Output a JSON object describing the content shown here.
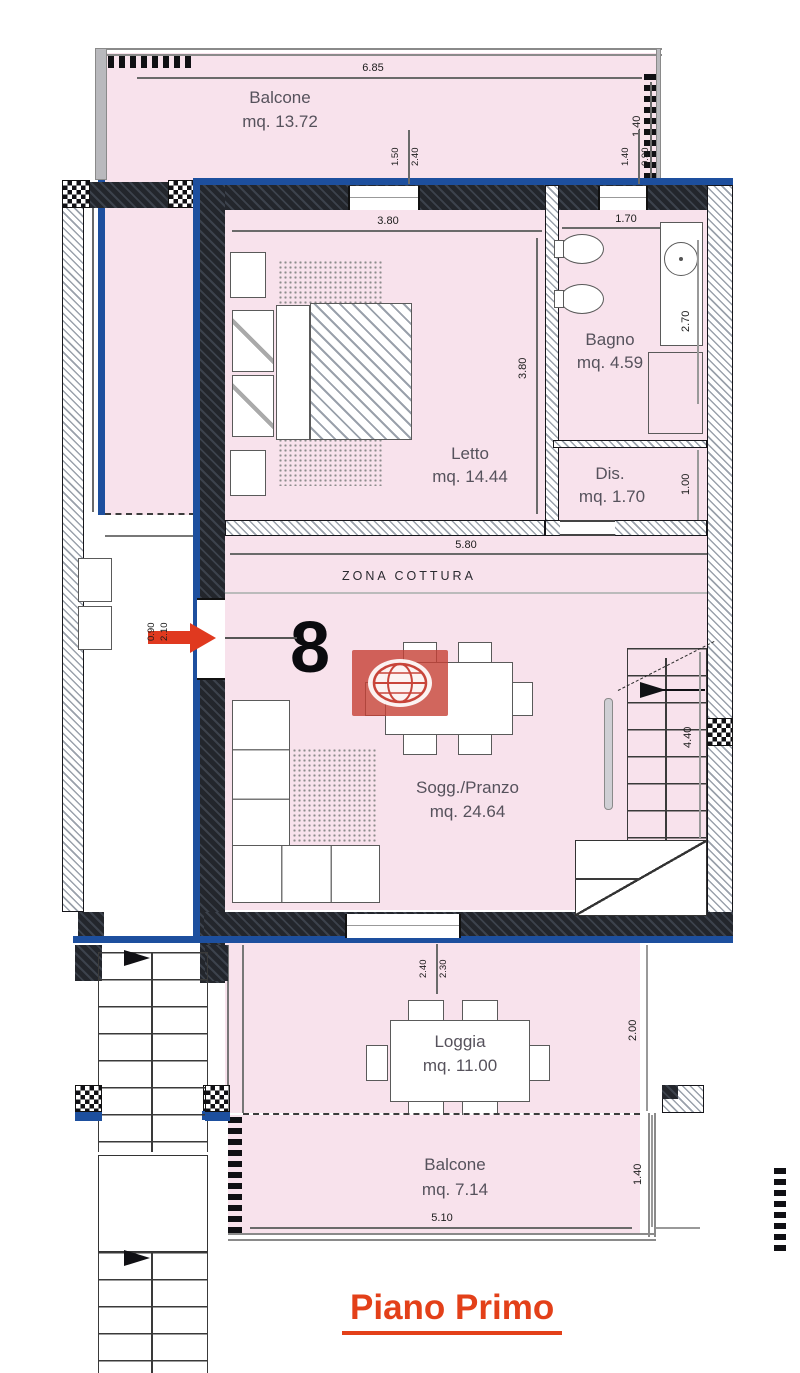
{
  "plan": {
    "floor_title": "Piano Primo",
    "unit_number": "8",
    "zone_label": "ZONA COTTURA"
  },
  "rooms": {
    "balcone_top": {
      "name": "Balcone",
      "area": "mq. 13.72"
    },
    "letto": {
      "name": "Letto",
      "area": "mq. 14.44"
    },
    "bagno": {
      "name": "Bagno",
      "area": "mq. 4.59"
    },
    "dis": {
      "name": "Dis.",
      "area": "mq. 1.70"
    },
    "sogg_pranzo": {
      "name": "Sogg./Pranzo",
      "area": "mq. 24.64"
    },
    "loggia": {
      "name": "Loggia",
      "area": "mq. 11.00"
    },
    "balcone_bottom": {
      "name": "Balcone",
      "area": "mq. 7.14"
    }
  },
  "dimensions": {
    "balcone_top_width": "6.85",
    "balcone_top_depth": "1.40",
    "side_left": "5.60",
    "letto_width": "3.80",
    "letto_depth": "3.80",
    "bagno_width": "1.70",
    "bagno_depth": "2.70",
    "dis_depth": "1.00",
    "living_width": "5.80",
    "stair_span": "4.40",
    "loggia_depth": "2.00",
    "balcone_bottom_depth": "1.40",
    "balcone_bottom_width": "5.10",
    "letto_window_width": "1.50",
    "letto_window_height": "2.40",
    "bagno_window_width": "1.40",
    "bagno_window_height": "0.90",
    "entry_door_width": "0.90",
    "entry_door_height": "2.10",
    "loggia_door_width": "2.40",
    "loggia_door_height": "2.30"
  },
  "colors": {
    "room_fill": "#f8e2ec",
    "wall_blue": "#1d4f9e",
    "accent_red": "#e0391f",
    "logo_red": "#c8453a"
  }
}
